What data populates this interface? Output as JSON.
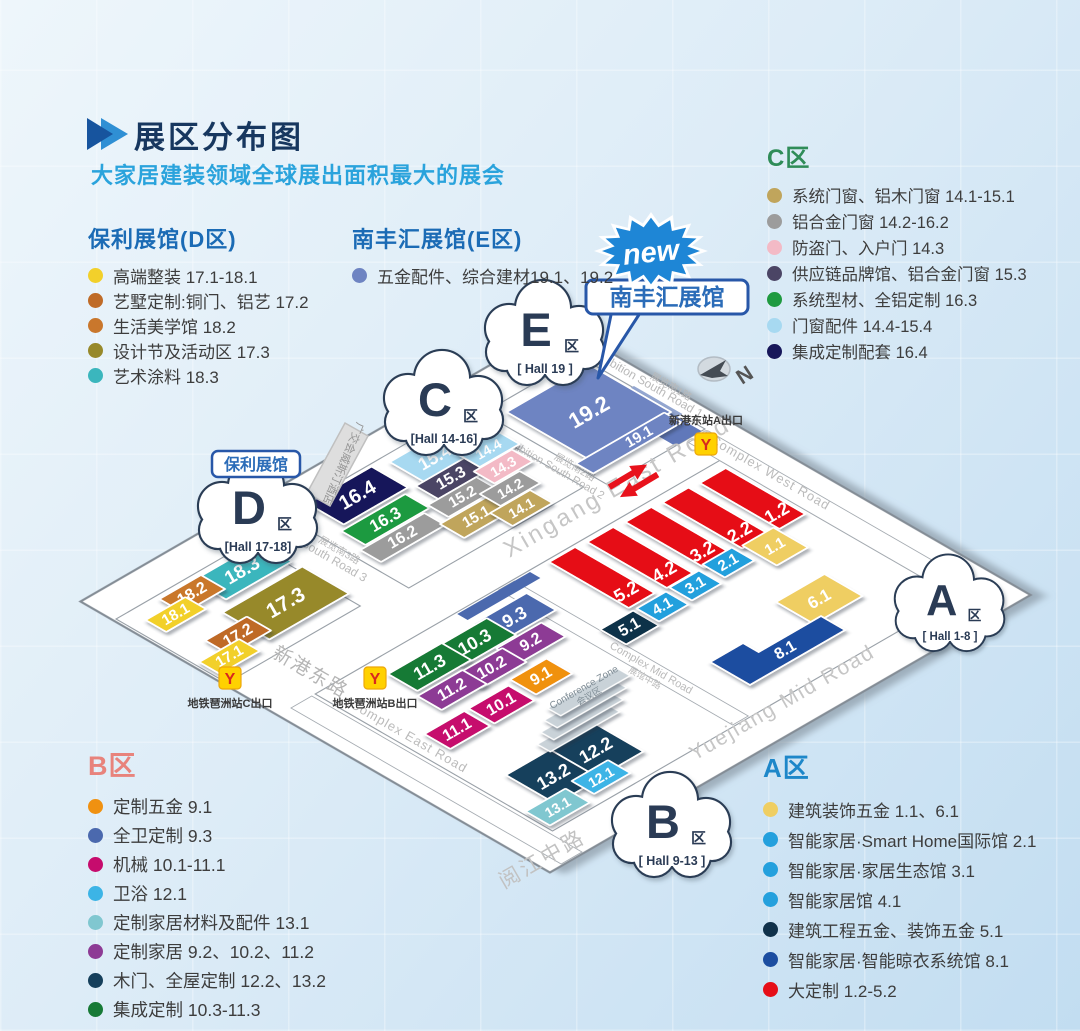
{
  "header": {
    "title": "展区分布图",
    "subtitle": "大家居建装领域全球展出面积最大的展会",
    "title_color": "#17375f",
    "subtitle_color": "#2aa3dc"
  },
  "legends": {
    "d": {
      "title": "保利展馆(D区)",
      "title_color": "#1b6bb5",
      "items": [
        {
          "label": "高端整装 17.1-18.1",
          "color": "#f2d02b"
        },
        {
          "label": "艺墅定制:铜门、铝艺 17.2",
          "color": "#bf6b27"
        },
        {
          "label": "生活美学馆 18.2",
          "color": "#c9772c"
        },
        {
          "label": "设计节及活动区 17.3",
          "color": "#97892a"
        },
        {
          "label": "艺术涂料 18.3",
          "color": "#3bb6bd"
        }
      ]
    },
    "e": {
      "title": "南丰汇展馆(E区)",
      "title_color": "#1b6bb5",
      "items": [
        {
          "label": "五金配件、综合建材19.1、19.2",
          "color": "#6e84c2"
        }
      ]
    },
    "c": {
      "title": "C区",
      "title_color": "#2f8c58",
      "items": [
        {
          "label": "系统门窗、铝木门窗 14.1-15.1",
          "color": "#c0a55c"
        },
        {
          "label": "铝合金门窗 14.2-16.2",
          "color": "#9c9c9c"
        },
        {
          "label": "防盗门、入户门 14.3",
          "color": "#f3bac6"
        },
        {
          "label": "供应链品牌馆、铝合金门窗 15.3",
          "color": "#4b4565"
        },
        {
          "label": "系统型材、全铝定制 16.3",
          "color": "#1f9a40"
        },
        {
          "label": "门窗配件 14.4-15.4",
          "color": "#a7d9f1"
        },
        {
          "label": "集成定制配套 16.4",
          "color": "#17175a"
        }
      ]
    },
    "b": {
      "title": "B区",
      "title_color": "#e8837c",
      "items": [
        {
          "label": "定制五金 9.1",
          "color": "#f09111"
        },
        {
          "label": "全卫定制 9.3",
          "color": "#4b69ae"
        },
        {
          "label": "机械 10.1-11.1",
          "color": "#c60c6d"
        },
        {
          "label": "卫浴 12.1",
          "color": "#3cb4e6"
        },
        {
          "label": "定制家居材料及配件 13.1",
          "color": "#80c7d0"
        },
        {
          "label": "定制家居 9.2、10.2、11.2",
          "color": "#8d3b95"
        },
        {
          "label": "木门、全屋定制 12.2、13.2",
          "color": "#153f5b"
        },
        {
          "label": "集成定制 10.3-11.3",
          "color": "#177a36"
        }
      ]
    },
    "a": {
      "title": "A区",
      "title_color": "#1e87c9",
      "items": [
        {
          "label": "建筑装饰五金 1.1、6.1",
          "color": "#efce62"
        },
        {
          "label": "智能家居·Smart Home国际馆 2.1",
          "color": "#24a0dd"
        },
        {
          "label": "智能家居·家居生态馆 3.1",
          "color": "#24a0dd"
        },
        {
          "label": "智能家居馆 4.1",
          "color": "#24a0dd"
        },
        {
          "label": "建筑工程五金、装饰五金 5.1",
          "color": "#10314a"
        },
        {
          "label": "智能家居·智能晾衣系统馆 8.1",
          "color": "#1c4da0"
        },
        {
          "label": "大定制 1.2-5.2",
          "color": "#e60e17"
        }
      ]
    },
    "_comment": ""
  },
  "map": {
    "new_badge": "new",
    "new_badge_color": "#1e86d6",
    "compass": "N",
    "icons": {
      "metro_glyph": "Y"
    },
    "callouts": {
      "poly": "保利展馆",
      "nanfeng": "南丰汇展馆",
      "border_color": "#2857a8",
      "text_color": "#2b6cb8"
    },
    "clouds": [
      {
        "letter": "E",
        "suffix": "区",
        "hall": "[ Hall 19 ]"
      },
      {
        "letter": "C",
        "suffix": "区",
        "hall": "[Hall 14-16]"
      },
      {
        "letter": "D",
        "suffix": "区",
        "hall": "[Hall 17-18]"
      },
      {
        "letter": "B",
        "suffix": "区",
        "hall": "[ Hall 9-13 ]"
      },
      {
        "letter": "A",
        "suffix": "区",
        "hall": "[ Hall 1-8 ]"
      }
    ],
    "roads": {
      "xingang_en": "Xingang East Road",
      "xingang_cn": "新港东路",
      "yuejiang_en": "Yuejiang Mid Road",
      "yuejiang_cn": "阅江中路",
      "complex_west": "Complex West Road",
      "complex_east": "Complex East Road",
      "complex_mid": "Complex Mid Road",
      "complex_mid_cn": "展馆中路",
      "south1": "Exhibition South Road 1",
      "south1_cn": "展览南1路",
      "south2": "Exhibition South Road 2",
      "south2_cn": "展览南2路",
      "south3": "Exhibition South Road 3",
      "south3_cn": "展览南3路",
      "conference": "Conference Zone",
      "conference_cn": "会议区",
      "hotel": "广交会威斯汀酒店"
    },
    "metro_exits": [
      {
        "label": "新港东站A出口"
      },
      {
        "label": "地铁琶洲站C出口"
      },
      {
        "label": "地铁琶洲站B出口"
      }
    ],
    "halls": [
      {
        "id": "16.4",
        "color": "#17175a"
      },
      {
        "id": "16.3",
        "color": "#1f9a40"
      },
      {
        "id": "16.2",
        "color": "#9c9c9c"
      },
      {
        "id": "15.4",
        "color": "#a7d9f1"
      },
      {
        "id": "15.3",
        "color": "#4b4565"
      },
      {
        "id": "15.2",
        "color": "#9c9c9c"
      },
      {
        "id": "15.1",
        "color": "#c0a55c"
      },
      {
        "id": "14.4",
        "color": "#a7d9f1"
      },
      {
        "id": "14.3",
        "color": "#f3bac6"
      },
      {
        "id": "14.2",
        "color": "#9c9c9c"
      },
      {
        "id": "14.1",
        "color": "#c0a55c"
      },
      {
        "id": "18.3",
        "color": "#3bb6bd"
      },
      {
        "id": "18.2",
        "color": "#c9772c"
      },
      {
        "id": "18.1",
        "color": "#f2d02b"
      },
      {
        "id": "17.3",
        "color": "#97892a"
      },
      {
        "id": "17.2",
        "color": "#bf6b27"
      },
      {
        "id": "17.1",
        "color": "#f2d02b"
      },
      {
        "id": "19.2",
        "color": "#6e84c2"
      },
      {
        "id": "19.1",
        "color": "#6e84c2"
      },
      {
        "id": "5.2",
        "color": "#e60e17"
      },
      {
        "id": "4.2",
        "color": "#e60e17"
      },
      {
        "id": "3.2",
        "color": "#e60e17"
      },
      {
        "id": "2.2",
        "color": "#e60e17"
      },
      {
        "id": "1.2",
        "color": "#e60e17"
      },
      {
        "id": "5.1",
        "color": "#10314a"
      },
      {
        "id": "4.1",
        "color": "#24a0dd"
      },
      {
        "id": "3.1",
        "color": "#24a0dd"
      },
      {
        "id": "2.1",
        "color": "#24a0dd"
      },
      {
        "id": "1.1",
        "color": "#efce62"
      },
      {
        "id": "6.1",
        "color": "#efce62"
      },
      {
        "id": "8.1",
        "color": "#1c4da0"
      },
      {
        "id": "9.3",
        "color": "#4b69ae"
      },
      {
        "id": "10.3",
        "color": "#177a36"
      },
      {
        "id": "11.3",
        "color": "#177a36"
      },
      {
        "id": "9.2",
        "color": "#8d3b95"
      },
      {
        "id": "10.2",
        "color": "#8d3b95"
      },
      {
        "id": "11.2",
        "color": "#8d3b95"
      },
      {
        "id": "9.1",
        "color": "#f09111"
      },
      {
        "id": "10.1",
        "color": "#c60c6d"
      },
      {
        "id": "11.1",
        "color": "#c60c6d"
      },
      {
        "id": "13.2",
        "color": "#153f5b"
      },
      {
        "id": "12.2",
        "color": "#153f5b"
      },
      {
        "id": "12.1",
        "color": "#3cb4e6"
      },
      {
        "id": "13.1",
        "color": "#80c7d0"
      }
    ]
  }
}
